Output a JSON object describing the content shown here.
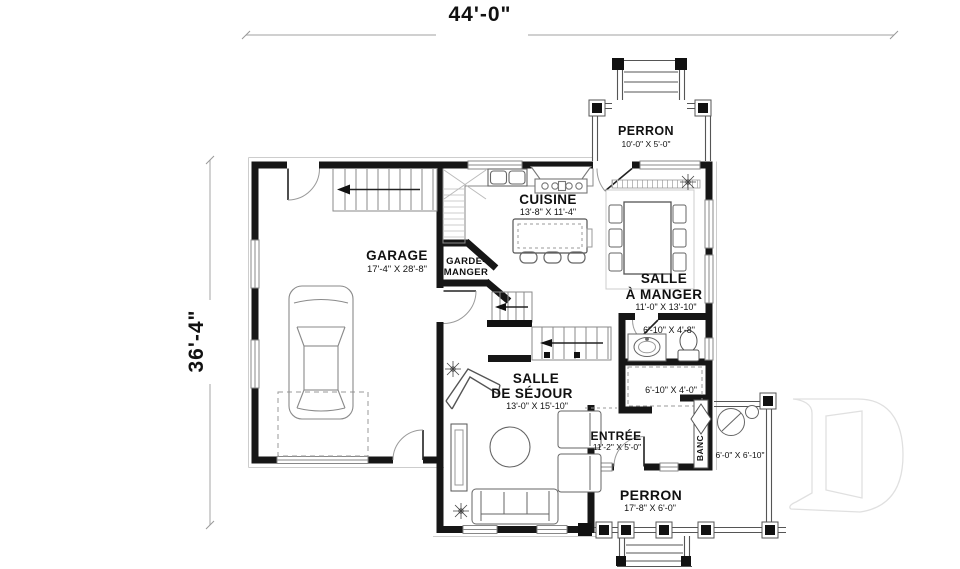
{
  "colors": {
    "wall": "#161616",
    "furniture_line": "#666666",
    "light_line": "#9a9a9a",
    "watermark": "#e0e0e0",
    "background": "#ffffff"
  },
  "dimensions": {
    "width_label": "44'-0\"",
    "depth_label": "36'-4\""
  },
  "rooms": {
    "garage": {
      "name": "GARAGE",
      "size": "17'-4\" X 28'-8\""
    },
    "cuisine": {
      "name": "CUISINE",
      "size": "13'-8\" X 11'-4\""
    },
    "garde_manger": {
      "line1": "GARDE-",
      "line2": "MANGER"
    },
    "salle_a_manger": {
      "line1": "SALLE",
      "line2": "À MANGER",
      "size": "11'-0\" X 13'-10\""
    },
    "salle_eau": {
      "size": "6'-10\" X 4'-8\""
    },
    "penderie": {
      "size": "6'-10\" X 4'-0\""
    },
    "salle_de_sejour": {
      "line1": "SALLE",
      "line2": "DE SÉJOUR",
      "size": "13'-0\" X 15'-10\""
    },
    "entree": {
      "name": "ENTRÉE",
      "size": "11'-2\" X 5'-0\""
    },
    "banc": {
      "name": "BANC"
    },
    "porche_cote": {
      "size": "6'-0\" X 6'-10\""
    },
    "perron_haut": {
      "name": "PERRON",
      "size": "10'-0\" X 5'-0\""
    },
    "perron_bas": {
      "name": "PERRON",
      "size": "17'-8\" X 6'-0\""
    }
  }
}
